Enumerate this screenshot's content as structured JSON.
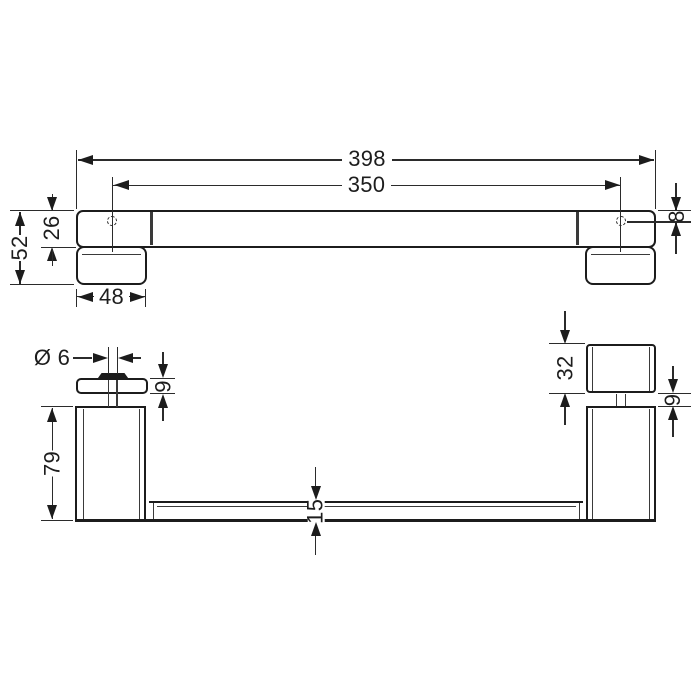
{
  "drawing": {
    "type": "technical-dimension-drawing",
    "subject": "door handle / grab bar with two glass mounting posts, plan view and front elevation",
    "units": "mm",
    "colors": {
      "background": "#ffffff",
      "object_line": "#1c1c1c",
      "dimension_line": "#2b2b2b",
      "text": "#1d1d1d"
    },
    "top_view": {
      "dimensions": {
        "overall_length": "398",
        "hole_spacing": "350",
        "hole_offset": "8",
        "total_depth": "52",
        "bar_depth": "26",
        "plate_width": "48"
      }
    },
    "front_view": {
      "dimensions": {
        "screw_diameter": "Ø 6",
        "plate_thickness": "9",
        "post_height": "79",
        "cap_height": "32",
        "cap_gap": "9",
        "bar_thickness": "15"
      }
    }
  }
}
